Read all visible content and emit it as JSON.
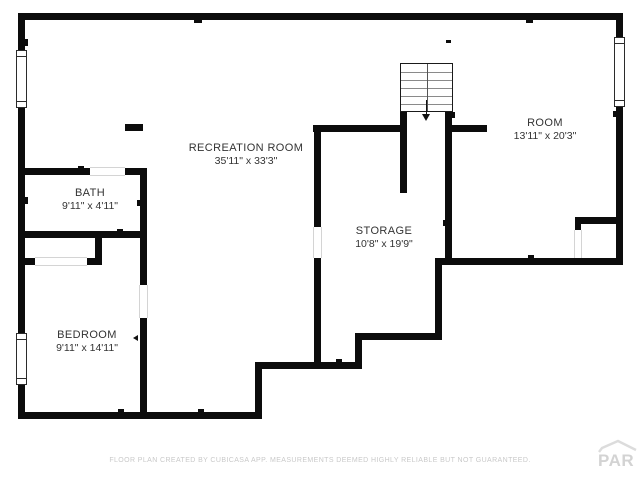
{
  "rooms": {
    "recreation": {
      "name": "RECREATION ROOM",
      "dims": "35'11\" x 33'3\""
    },
    "bath": {
      "name": "BATH",
      "dims": "9'11\" x 4'11\""
    },
    "bedroom": {
      "name": "BEDROOM",
      "dims": "9'11\" x 14'11\""
    },
    "storage": {
      "name": "STORAGE",
      "dims": "10'8\" x 19'9\""
    },
    "room": {
      "name": "ROOM",
      "dims": "13'11\" x 20'3\""
    }
  },
  "stairs": {
    "icon": "stairs-down-arrow",
    "treads": 6
  },
  "footer": {
    "disclaimer": "FLOOR PLAN CREATED BY CUBICASA APP. MEASUREMENTS DEEMED HIGHLY RELIABLE BUT NOT GUARANTEED."
  },
  "watermark": {
    "text": "PAR",
    "icon": "house-roof-icon"
  },
  "colors": {
    "wall": "#0c0c0c",
    "label": "#333333",
    "footer_text": "#c9c9c9",
    "watermark": "#d3d3d3",
    "background": "#ffffff"
  }
}
